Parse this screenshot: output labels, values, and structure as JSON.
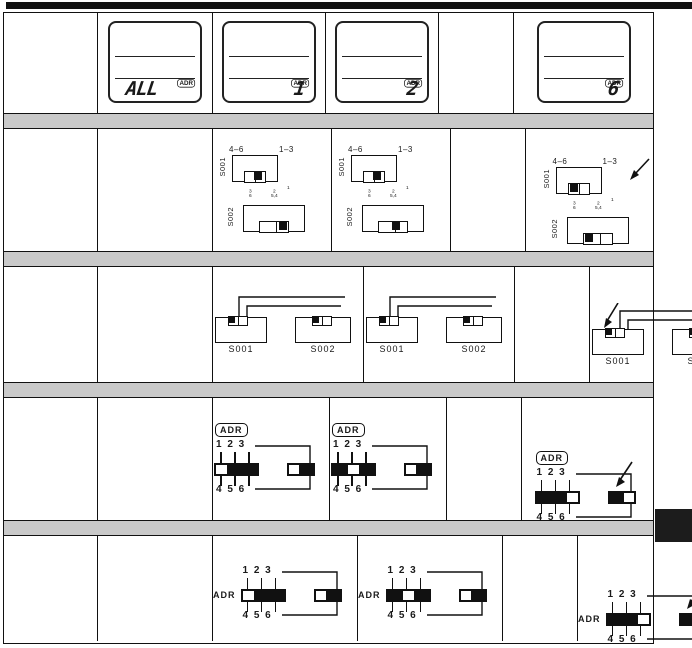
{
  "lcd_row": {
    "badge_label": "ADR",
    "cells": [
      {
        "value": "ALL"
      },
      {
        "value": "1"
      },
      {
        "value": "2"
      },
      {
        "value": "6"
      }
    ]
  },
  "rotary_row": {
    "range_left": "4–6",
    "range_right": "1–3",
    "s001_label": "S001",
    "s002_label": "S002",
    "ticks": {
      "g1_top": "3",
      "g1_bot": "6",
      "g2_top": "2",
      "g2_bot": "5,4",
      "sup": "1"
    },
    "cells": [
      {
        "s001_pos": "mid",
        "s002_pos": "right"
      },
      {
        "s001_pos": "mid",
        "s002_pos": "mid"
      },
      {
        "s001_pos": "left",
        "s002_pos": "left"
      }
    ]
  },
  "slide_row": {
    "s001_label": "S001",
    "s002_label": "S002",
    "cells": [
      {
        "s001_pos": "mid",
        "s002_pos": "mid"
      },
      {
        "s001_pos": "left",
        "s002_pos": "right"
      },
      {
        "s001_pos": "right",
        "s002_pos": "right"
      }
    ]
  },
  "dip_badge_row": {
    "adr_label": "ADR",
    "top_digits": "1 2 3",
    "bottom_digits": "4 5 6",
    "cells": [
      {
        "bar": "wbb",
        "box": "wb"
      },
      {
        "bar": "bwb",
        "box": "wb"
      },
      {
        "bar": "bbw",
        "box": "bw"
      }
    ]
  },
  "dip_text_row": {
    "adr_label": "ADR",
    "top_digits": "1 2 3",
    "bottom_digits": "4 5 6",
    "cells": [
      {
        "bar": "wbb",
        "box": "wb"
      },
      {
        "bar": "bwb",
        "box": "wb"
      },
      {
        "bar": "bbw",
        "box": "bw"
      }
    ]
  },
  "colors": {
    "band": "#c9c9c9",
    "ink": "#1a1a1a"
  }
}
